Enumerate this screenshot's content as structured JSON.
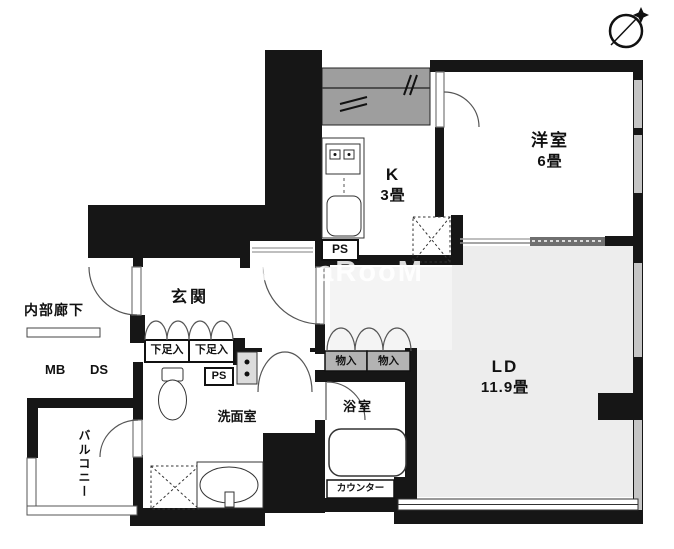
{
  "watermark": "CasaRooM",
  "colors": {
    "wall": "#161616",
    "ld_floor": "#ededed",
    "duct_strip": "#9e9e9e",
    "window_glass": "#c5c5c5",
    "closet_fill": "#b3b3b3"
  },
  "rooms": {
    "western": {
      "label": "洋室",
      "size": "6畳"
    },
    "kitchen": {
      "label": "K",
      "size": "3畳"
    },
    "living_dining": {
      "label": "LD",
      "size": "11.9畳"
    },
    "entrance": {
      "label": "玄関"
    },
    "washroom": {
      "label": "洗面室"
    },
    "bathroom": {
      "label": "浴室"
    },
    "balcony": {
      "label": "バルコニー"
    },
    "inner_corridor": {
      "label": "内部廊下"
    }
  },
  "small_labels": {
    "mb": "MB",
    "ds": "DS",
    "ps_upper": "PS",
    "ps_lower": "PS",
    "shoe_left": "下足入",
    "shoe_right": "下足入",
    "storage_left": "物入",
    "storage_right": "物入",
    "counter": "カウンター"
  }
}
